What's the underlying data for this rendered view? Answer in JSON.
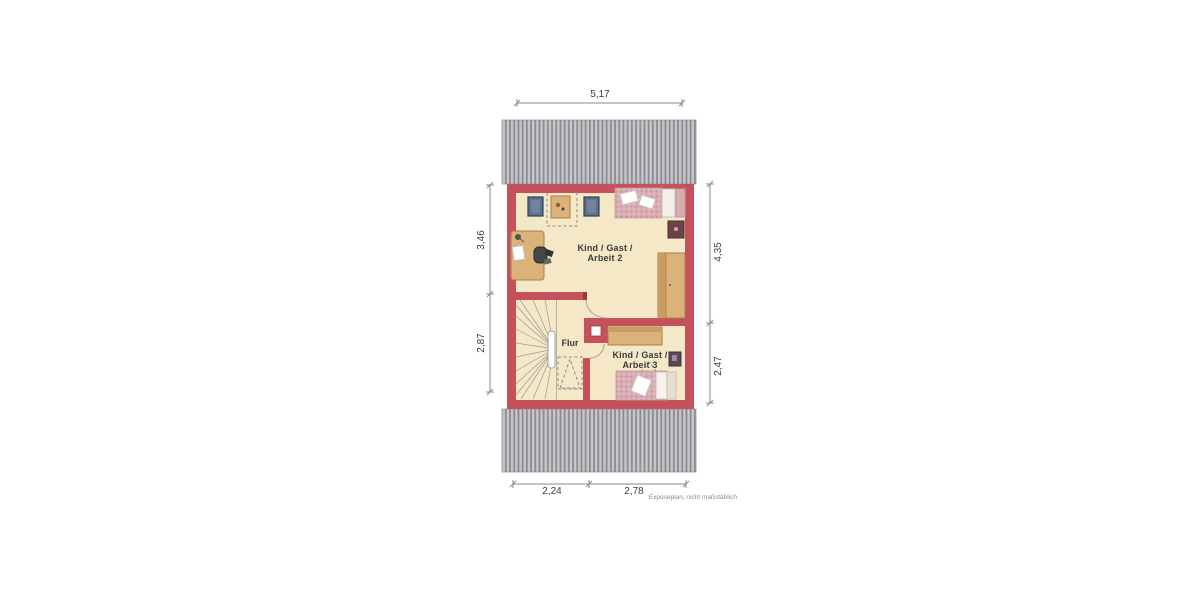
{
  "plan": {
    "type": "floor_plan",
    "rooms": {
      "room2": {
        "line1": "Kind / Gast /",
        "line2": "Arbeit 2"
      },
      "room3": {
        "line1": "Kind / Gast /",
        "line2": "Arbeit 3"
      },
      "hallway": {
        "label": "Flur"
      }
    },
    "dimensions": {
      "top": "5,17",
      "left_upper": "3,46",
      "left_lower": "2,87",
      "right_upper": "4,35",
      "right_lower": "2,47",
      "bottom_left": "2,24",
      "bottom_right": "2,78"
    },
    "footnote": "Exposeplan, nicht maßstäblich",
    "colors": {
      "wall": "#c4515b",
      "wall_dark": "#9c3a44",
      "floor": "#f4e8c7",
      "roof_base": "#c7c7cb",
      "roof_stripe": "#88888e",
      "wood": "#dcb27b",
      "wood_dark": "#a87f4a",
      "bed_pink": "#d9acb2",
      "bed_dot": "#bb8d94",
      "chair_blue": "#5d6f8a",
      "chair_dark": "#32405a",
      "dimension_line": "#8a8a8a",
      "text": "#3c3c3c"
    }
  }
}
